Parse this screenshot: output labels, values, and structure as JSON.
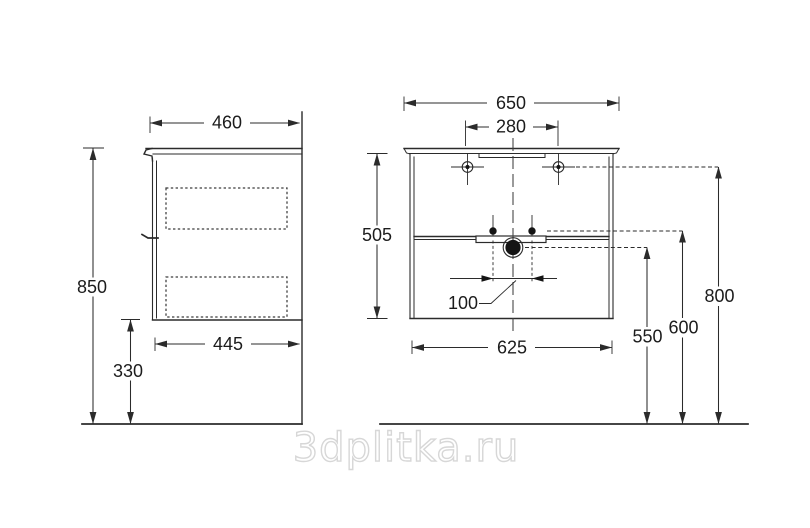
{
  "watermark": {
    "text": "3dplitka.ru"
  },
  "colors": {
    "line": "#2b2b2b",
    "text": "#1c1c1c",
    "watermark_stroke": "#d7d7d7",
    "background": "#ffffff"
  },
  "side_view": {
    "top_depth": "460",
    "overall_height": "850",
    "body_depth": "445",
    "floor_clearance": "330"
  },
  "front_view": {
    "overall_width": "650",
    "top_holes_span": "280",
    "body_height": "505",
    "bracket_span": "100",
    "body_width": "625",
    "drain_height": "550",
    "bracket_height": "600",
    "top_holes_height": "800"
  }
}
